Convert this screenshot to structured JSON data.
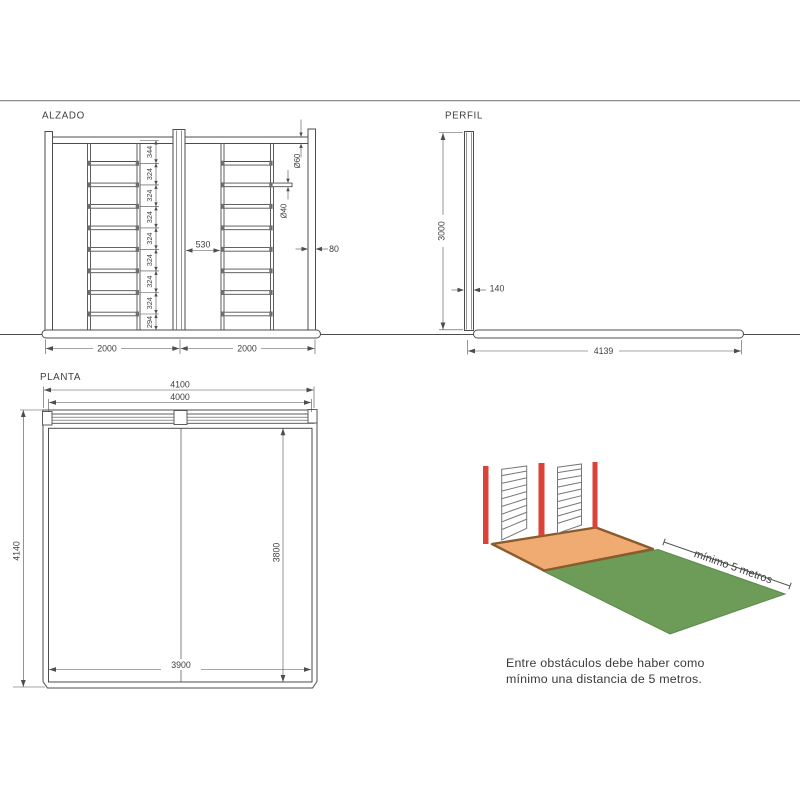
{
  "views": {
    "alzado": {
      "label": "ALZADO",
      "chain": [
        "344",
        "324",
        "324",
        "324",
        "324",
        "324",
        "324",
        "324",
        "294"
      ],
      "beam_diameter": "Ø60",
      "rung_diameter": "Ø40",
      "ladder_gap": "530",
      "post_width": "80",
      "bay_left": "2000",
      "bay_right": "2000"
    },
    "perfil": {
      "label": "PERFIL",
      "height": "3000",
      "post_depth": "140",
      "base_length": "4139"
    },
    "planta": {
      "label": "PLANTA",
      "overall_width": "4100",
      "frame_width": "4000",
      "overall_depth": "4140",
      "mat_depth": "3800",
      "mat_width": "3900"
    },
    "illustration": {
      "distance_label": "mínimo 5 metros",
      "caption_line1": "Entre obstáculos debe haber como",
      "caption_line2": "mínimo una distancia de 5 metros.",
      "colors": {
        "post_red": "#dc4237",
        "platform_orange": "#f0ab73",
        "platform_edge": "#8a5c2c",
        "mat_green": "#6d9b58"
      }
    }
  }
}
